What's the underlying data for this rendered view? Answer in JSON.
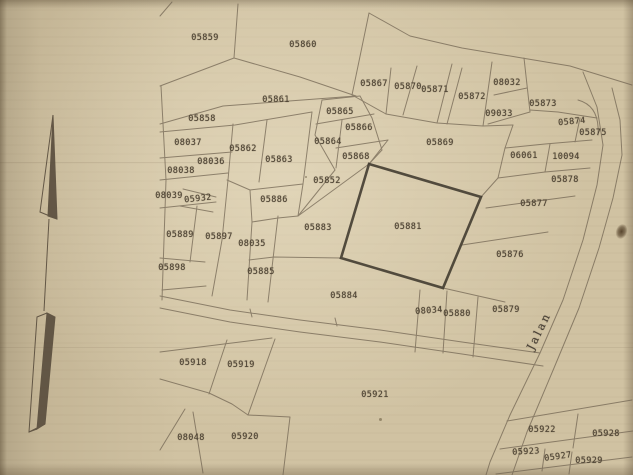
{
  "map": {
    "road_label": "Jalan",
    "colors": {
      "paper": "#d0c2a2",
      "boundary_line": "#6f6250",
      "bold_parcel_outline": "#3a3429",
      "label_text": "#4f4536"
    },
    "icons": {
      "north_arrow": "north-arrow-icon"
    },
    "highlighted_parcel": "05881",
    "parcels": [
      {
        "id": "05859",
        "x": 205,
        "y": 38
      },
      {
        "id": "05860",
        "x": 303,
        "y": 45
      },
      {
        "id": "05861",
        "x": 276,
        "y": 100
      },
      {
        "id": "05858",
        "x": 202,
        "y": 119
      },
      {
        "id": "08037",
        "x": 188,
        "y": 143
      },
      {
        "id": "05862",
        "x": 243,
        "y": 149
      },
      {
        "id": "05863",
        "x": 279,
        "y": 160
      },
      {
        "id": "08036",
        "x": 211,
        "y": 162
      },
      {
        "id": "08038",
        "x": 181,
        "y": 171
      },
      {
        "id": "08039",
        "x": 169,
        "y": 196
      },
      {
        "id": "05932",
        "x": 198,
        "y": 199,
        "r": -6
      },
      {
        "id": "05886",
        "x": 274,
        "y": 200
      },
      {
        "id": "05889",
        "x": 180,
        "y": 235
      },
      {
        "id": "05897",
        "x": 219,
        "y": 237
      },
      {
        "id": "08035",
        "x": 252,
        "y": 244
      },
      {
        "id": "05898",
        "x": 172,
        "y": 268
      },
      {
        "id": "05885",
        "x": 261,
        "y": 272
      },
      {
        "id": "05865",
        "x": 340,
        "y": 112
      },
      {
        "id": "05866",
        "x": 359,
        "y": 128
      },
      {
        "id": "05864",
        "x": 328,
        "y": 142
      },
      {
        "id": "05868",
        "x": 356,
        "y": 157
      },
      {
        "id": "05852",
        "x": 327,
        "y": 181
      },
      {
        "id": "05883",
        "x": 318,
        "y": 228
      },
      {
        "id": "05881",
        "x": 408,
        "y": 227
      },
      {
        "id": "05869",
        "x": 440,
        "y": 143
      },
      {
        "id": "05867",
        "x": 374,
        "y": 84
      },
      {
        "id": "05870",
        "x": 408,
        "y": 87
      },
      {
        "id": "05871",
        "x": 435,
        "y": 90
      },
      {
        "id": "05872",
        "x": 472,
        "y": 97
      },
      {
        "id": "08032",
        "x": 507,
        "y": 83
      },
      {
        "id": "09033",
        "x": 499,
        "y": 114
      },
      {
        "id": "05873",
        "x": 543,
        "y": 104
      },
      {
        "id": "05874",
        "x": 572,
        "y": 122,
        "r": -5
      },
      {
        "id": "05875",
        "x": 593,
        "y": 133
      },
      {
        "id": "06061",
        "x": 524,
        "y": 156
      },
      {
        "id": "10094",
        "x": 566,
        "y": 157
      },
      {
        "id": "05878",
        "x": 565,
        "y": 180
      },
      {
        "id": "05877",
        "x": 534,
        "y": 204
      },
      {
        "id": "05876",
        "x": 510,
        "y": 255
      },
      {
        "id": "05879",
        "x": 506,
        "y": 310
      },
      {
        "id": "05884",
        "x": 344,
        "y": 296
      },
      {
        "id": "08034",
        "x": 429,
        "y": 311,
        "r": -4
      },
      {
        "id": "05880",
        "x": 457,
        "y": 314
      },
      {
        "id": "05918",
        "x": 193,
        "y": 363
      },
      {
        "id": "05919",
        "x": 241,
        "y": 365
      },
      {
        "id": "08048",
        "x": 191,
        "y": 438
      },
      {
        "id": "05920",
        "x": 245,
        "y": 437
      },
      {
        "id": "05921",
        "x": 375,
        "y": 395
      },
      {
        "id": "05922",
        "x": 542,
        "y": 430
      },
      {
        "id": "05928",
        "x": 606,
        "y": 434
      },
      {
        "id": "05923",
        "x": 526,
        "y": 452,
        "r": -3
      },
      {
        "id": "05927",
        "x": 558,
        "y": 457,
        "r": -8
      },
      {
        "id": "05929",
        "x": 589,
        "y": 461
      }
    ]
  }
}
